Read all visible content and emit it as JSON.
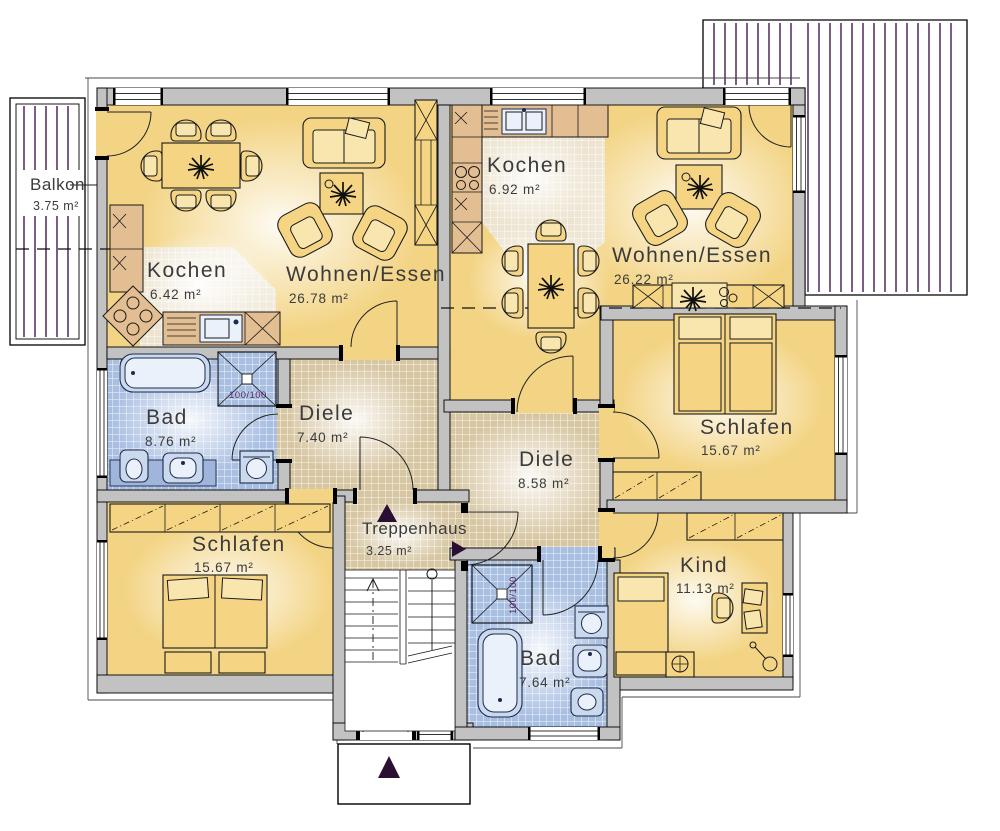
{
  "plan": {
    "rooms": {
      "balkon": {
        "name": "Balkon",
        "area": "3.75 m²"
      },
      "kochen_left": {
        "name": "Kochen",
        "area": "6.42 m²"
      },
      "wohnen_essen_left": {
        "name": "Wohnen/Essen",
        "area": "26.78 m²"
      },
      "kochen_right": {
        "name": "Kochen",
        "area": "6.92 m²"
      },
      "wohnen_essen_right": {
        "name": "Wohnen/Essen",
        "area": "26.22 m²"
      },
      "bad_left": {
        "name": "Bad",
        "area": "8.76 m²"
      },
      "diele_left": {
        "name": "Diele",
        "area": "7.40 m²"
      },
      "diele_right": {
        "name": "Diele",
        "area": "8.58 m²"
      },
      "schlafen_left": {
        "name": "Schlafen",
        "area": "15.67 m²"
      },
      "schlafen_right": {
        "name": "Schlafen",
        "area": "15.67 m²"
      },
      "treppenhaus": {
        "name": "Treppenhaus",
        "area": "3.25 m²"
      },
      "kind": {
        "name": "Kind",
        "area": "11.13 m²"
      },
      "bad_right": {
        "name": "Bad",
        "area": "7.64 m²"
      }
    },
    "fixtures": {
      "shower_left_size": "100/100",
      "shower_right_size": "100/100"
    },
    "colors": {
      "room_yellow": "#F3D484",
      "wall_gray": "#C2C2C2",
      "bath_tile_blue": "#A9BFE2",
      "hall_tile_tan": "#D7C6A2",
      "kitchen_tile_cream": "#EDE4D0",
      "deck_line_purple": "#45184F",
      "furniture_yellow": "#F5D584",
      "counter_tan": "#E3BE92"
    }
  }
}
